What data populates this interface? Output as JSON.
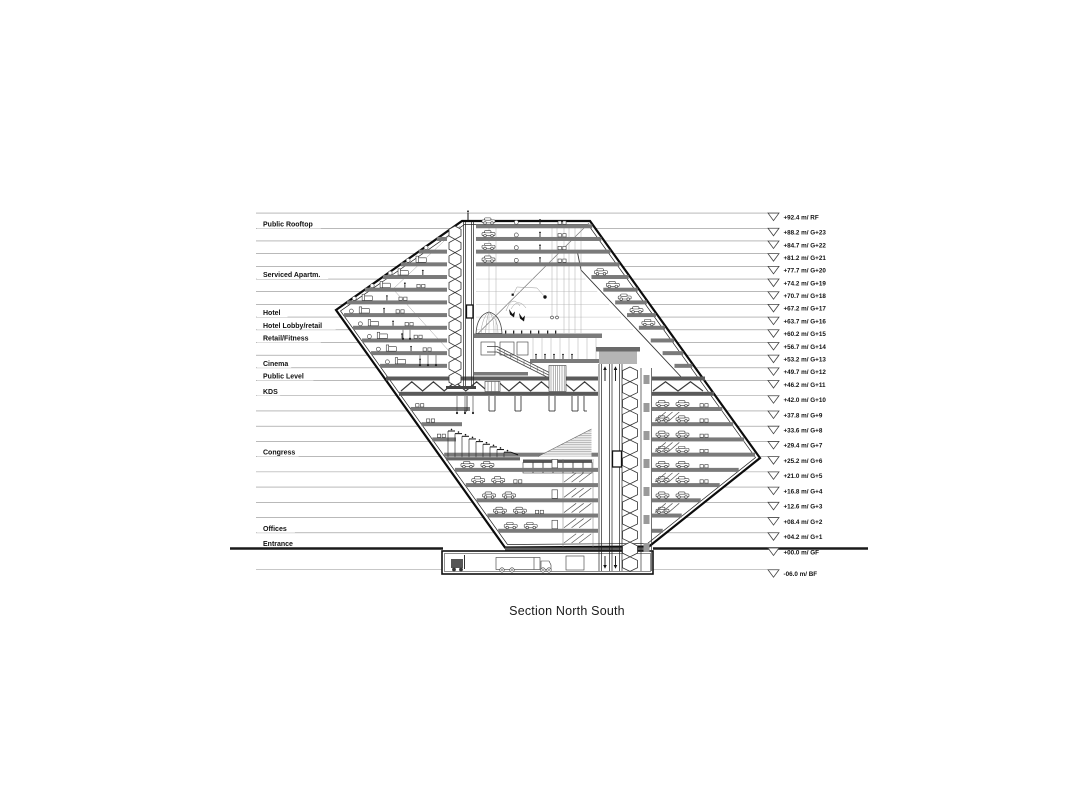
{
  "title": "Section North South",
  "floor_labels": [
    {
      "text": "Public Rooftop",
      "level": "G+23"
    },
    {
      "text": "Serviced Apartm.",
      "level": "G+19"
    },
    {
      "text": "Hotel",
      "level": "G+16"
    },
    {
      "text": "Hotel Lobby/retail",
      "level": "G+15"
    },
    {
      "text": "Retail/Fitness",
      "level": "G+14"
    },
    {
      "text": "Cinema",
      "level": "G+12"
    },
    {
      "text": "Public Level",
      "level": "G+11"
    },
    {
      "text": "KDS",
      "level": "G+10"
    },
    {
      "text": "Congress",
      "level": "G+6"
    },
    {
      "text": "Offices",
      "level": "G+1"
    },
    {
      "text": "Entrance",
      "level": "GF"
    }
  ],
  "level_markers": [
    {
      "label": "+92.4 m/ RF",
      "elevation_m": 92.4,
      "level": "RF"
    },
    {
      "label": "+88.2 m/ G+23",
      "elevation_m": 88.2,
      "level": "G+23"
    },
    {
      "label": "+84.7 m/ G+22",
      "elevation_m": 84.7,
      "level": "G+22"
    },
    {
      "label": "+81.2 m/ G+21",
      "elevation_m": 81.2,
      "level": "G+21"
    },
    {
      "label": "+77.7 m/ G+20",
      "elevation_m": 77.7,
      "level": "G+20"
    },
    {
      "label": "+74.2 m/ G+19",
      "elevation_m": 74.2,
      "level": "G+19"
    },
    {
      "label": "+70.7 m/ G+18",
      "elevation_m": 70.7,
      "level": "G+18"
    },
    {
      "label": "+67.2 m/ G+17",
      "elevation_m": 67.2,
      "level": "G+17"
    },
    {
      "label": "+63.7 m/ G+16",
      "elevation_m": 63.7,
      "level": "G+16"
    },
    {
      "label": "+60.2 m/ G+15",
      "elevation_m": 60.2,
      "level": "G+15"
    },
    {
      "label": "+56.7 m/ G+14",
      "elevation_m": 56.7,
      "level": "G+14"
    },
    {
      "label": "+53.2 m/ G+13",
      "elevation_m": 53.2,
      "level": "G+13"
    },
    {
      "label": "+49.7 m/ G+12",
      "elevation_m": 49.7,
      "level": "G+12"
    },
    {
      "label": "+46.2 m/ G+11",
      "elevation_m": 46.2,
      "level": "G+11"
    },
    {
      "label": "+42.0 m/ G+10",
      "elevation_m": 42.0,
      "level": "G+10"
    },
    {
      "label": "+37.8 m/ G+9",
      "elevation_m": 37.8,
      "level": "G+9"
    },
    {
      "label": "+33.6 m/ G+8",
      "elevation_m": 33.6,
      "level": "G+8"
    },
    {
      "label": "+29.4 m/ G+7",
      "elevation_m": 29.4,
      "level": "G+7"
    },
    {
      "label": "+25.2 m/ G+6",
      "elevation_m": 25.2,
      "level": "G+6"
    },
    {
      "label": "+21.0 m/ G+5",
      "elevation_m": 21.0,
      "level": "G+5"
    },
    {
      "label": "+16.8 m/ G+4",
      "elevation_m": 16.8,
      "level": "G+4"
    },
    {
      "label": "+12.6 m/ G+3",
      "elevation_m": 12.6,
      "level": "G+3"
    },
    {
      "label": "+08.4 m/ G+2",
      "elevation_m": 8.4,
      "level": "G+2"
    },
    {
      "label": "+04.2 m/ G+1",
      "elevation_m": 4.2,
      "level": "G+1"
    },
    {
      "label": "+00.0 m/ GF",
      "elevation_m": 0.0,
      "level": "GF"
    },
    {
      "label": "-06.0 m/ BF",
      "elevation_m": -6.0,
      "level": "BF"
    }
  ]
}
